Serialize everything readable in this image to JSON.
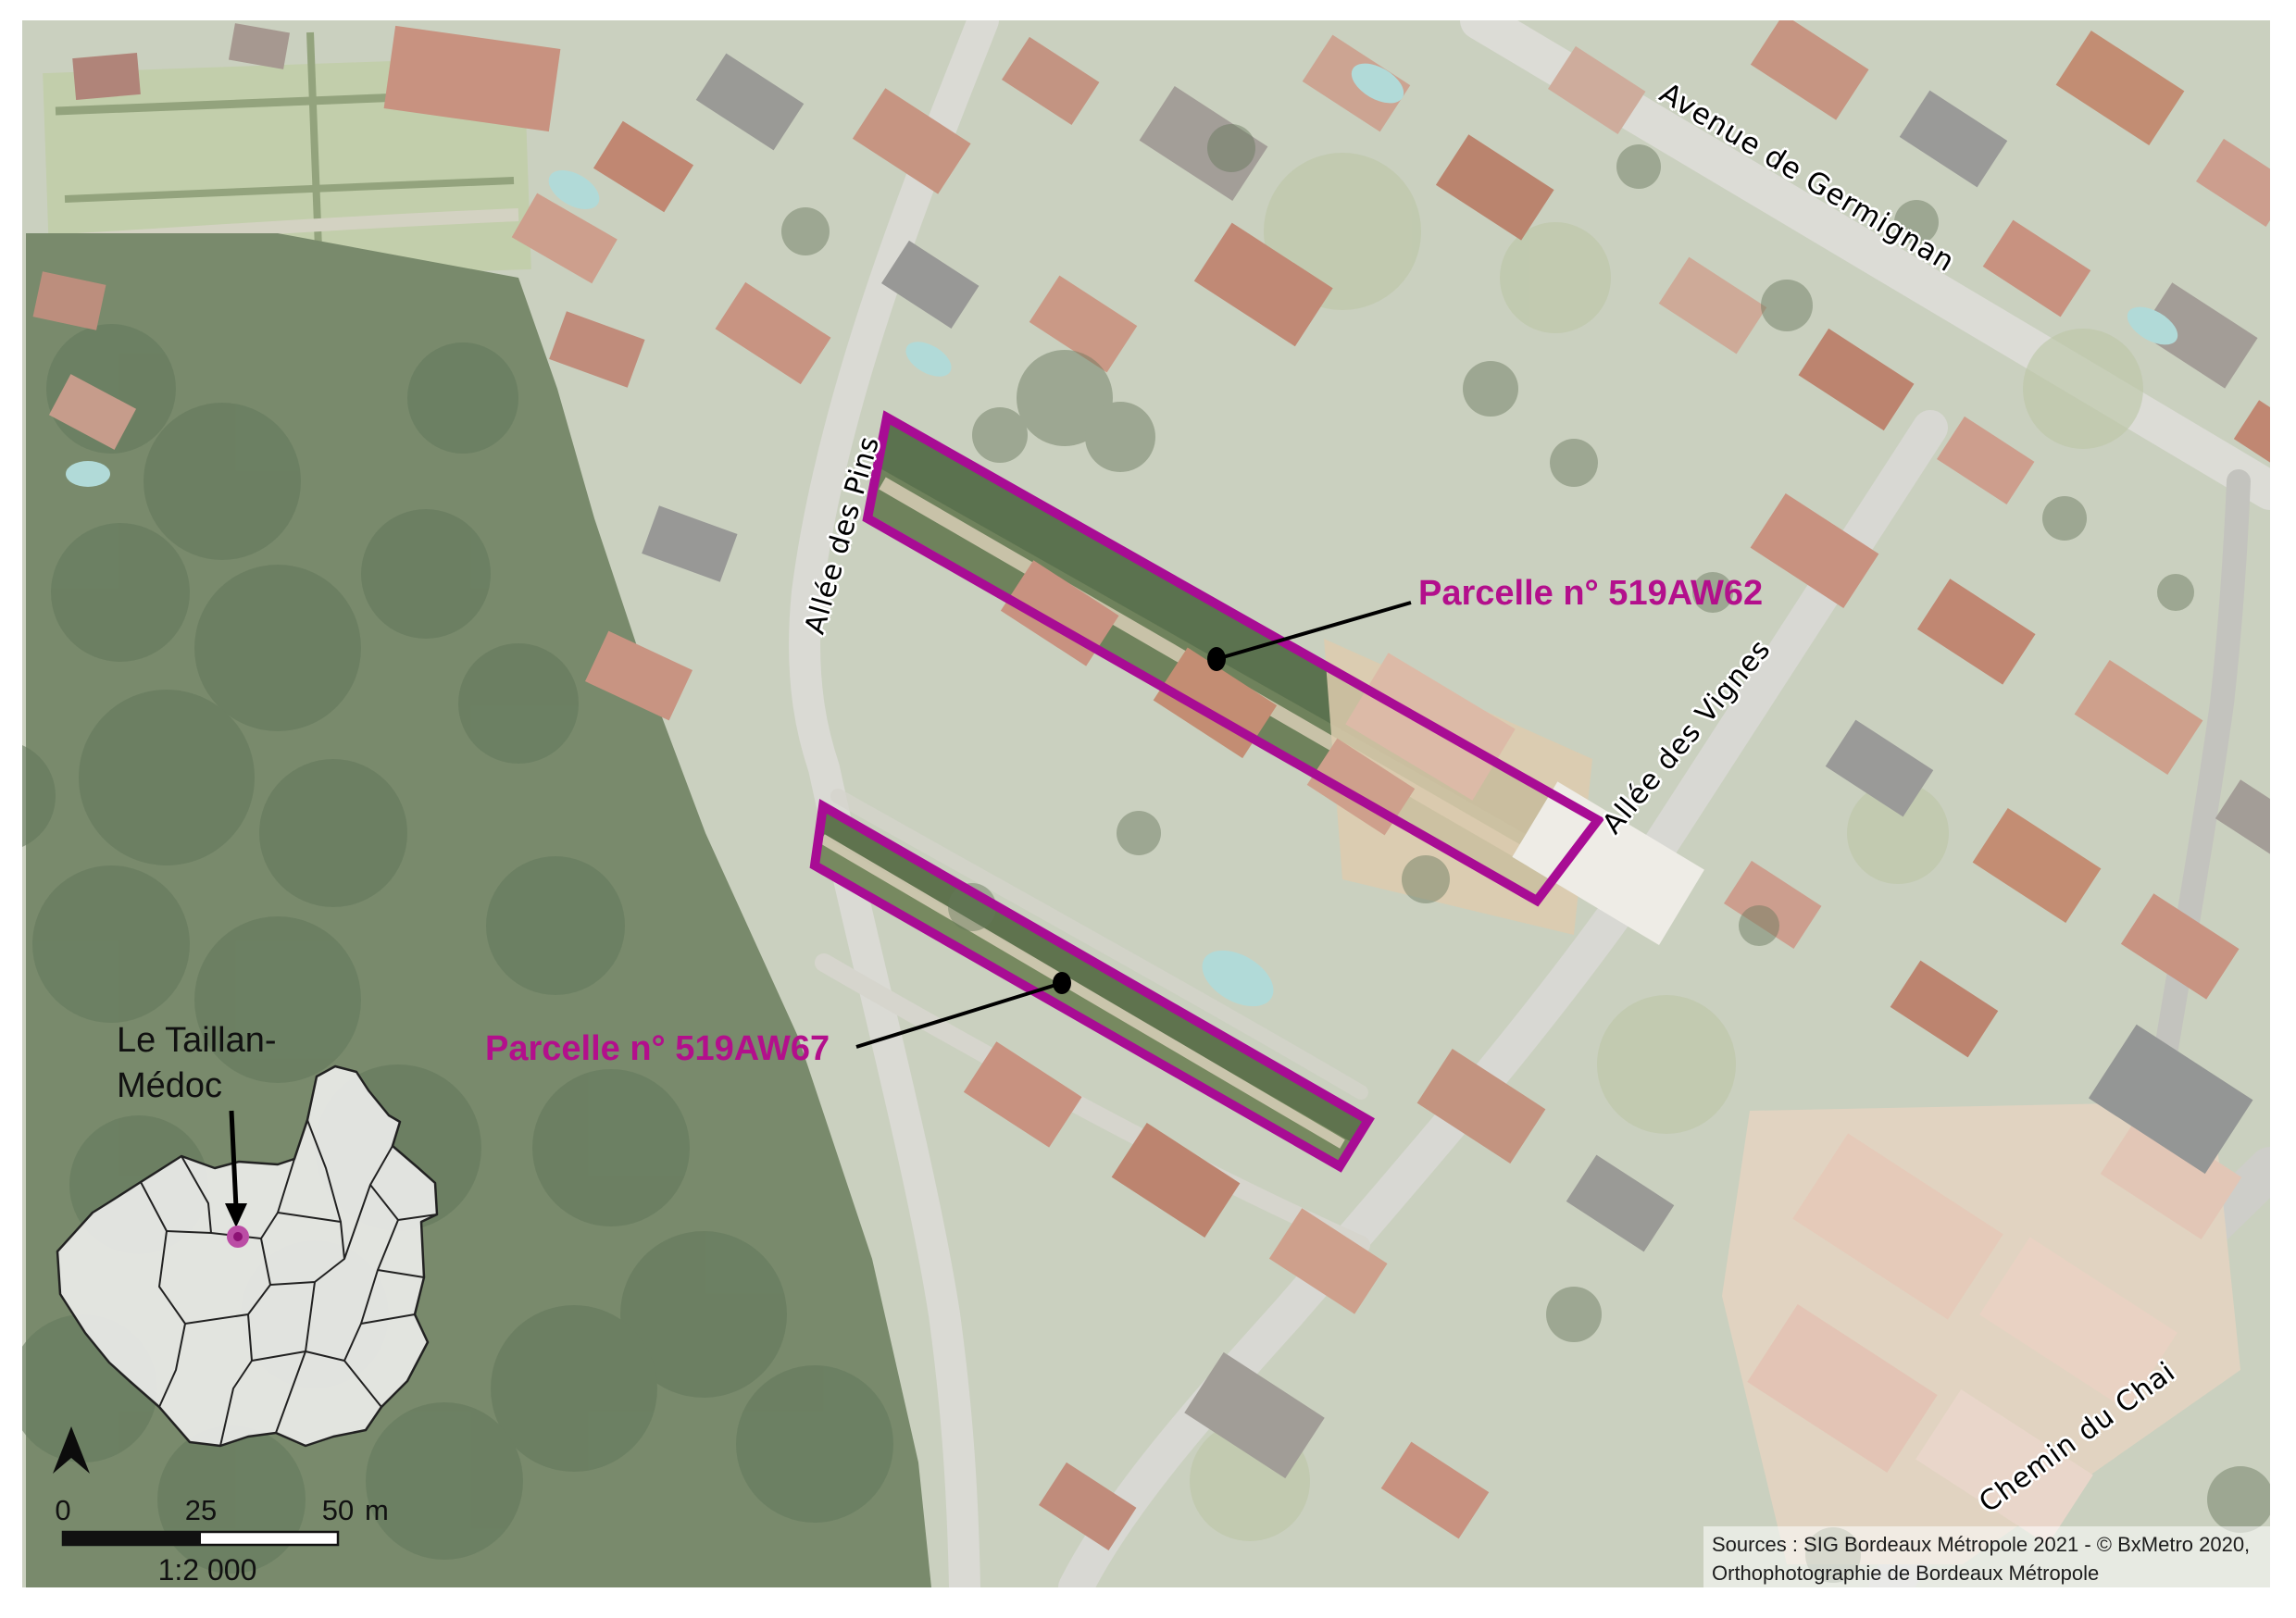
{
  "overlay": {
    "parcels": [
      {
        "id": "519AW62",
        "label": "Parcelle n° 519AW62",
        "outline_color": "#A80C94",
        "label_color": "#B30F8C"
      },
      {
        "id": "519AW67",
        "label": "Parcelle n° 519AW67",
        "outline_color": "#A80C94",
        "label_color": "#B30F8C"
      }
    ],
    "streets": [
      {
        "name": "Avenue de Germignan"
      },
      {
        "name": "Allée des Pins"
      },
      {
        "name": "Allée des Vignes"
      },
      {
        "name": "Chemin du Chai"
      }
    ]
  },
  "inset": {
    "commune_name_line1": "Le Taillan-",
    "commune_name_line2": "Médoc",
    "marker_color": "#bb4da5"
  },
  "scale_bar": {
    "tick_0": "0",
    "tick_25": "25",
    "tick_50": "50",
    "unit": "m",
    "scale_ratio": "1:2 000"
  },
  "attribution": {
    "line1": "Sources : SIG Bordeaux Métropole 2021 - © BxMetro 2020,",
    "line2": "Orthophotographie de Bordeaux Métropole"
  }
}
